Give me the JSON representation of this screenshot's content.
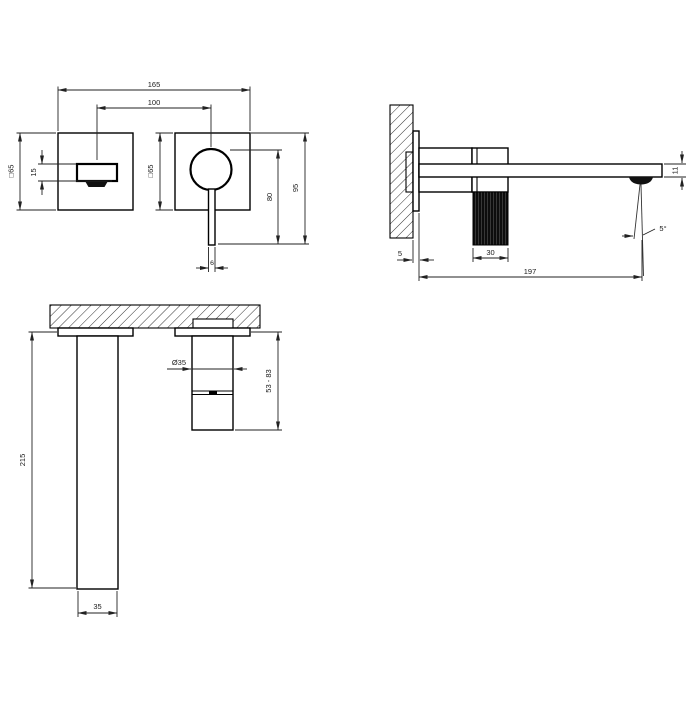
{
  "drawing": {
    "line_color": "#1a1a1a",
    "grip_color": "#0d0d0d",
    "views": {
      "front": {
        "dims": {
          "overall_width": "165",
          "spout_to_handle_centers": "100",
          "spout_plate_size": "□65",
          "handle_plate_size": "□65",
          "spout_height": "15",
          "handle_lever_drop": "80",
          "plate_top_to_lever_tip": "95",
          "lever_width": "6"
        }
      },
      "side": {
        "dims": {
          "plate_offset_from_wall": "5",
          "handle_grip_depth": "30",
          "spout_reach": "197",
          "spout_tip_height": "11",
          "spray_angle": "5°"
        }
      },
      "rough_in": {
        "dims": {
          "supply_body_length": "215",
          "supply_body_width": "35",
          "cartridge_diameter": "Ø35",
          "cartridge_depth_range": "53 - 83"
        }
      }
    }
  }
}
